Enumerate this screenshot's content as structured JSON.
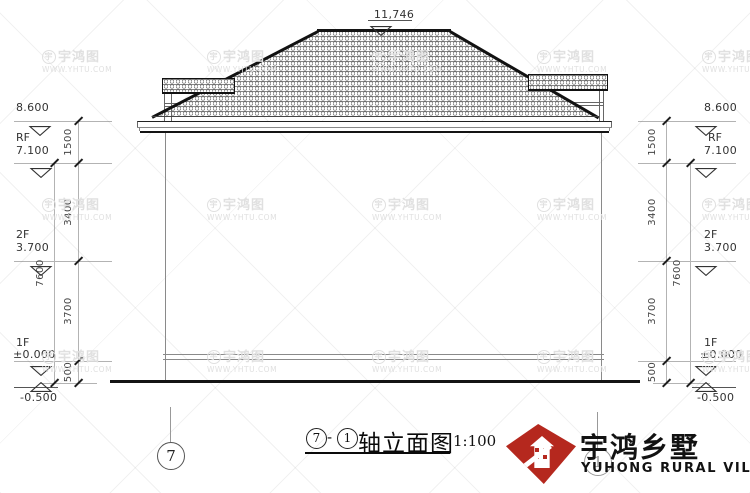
{
  "watermark": {
    "brand": "宇鸿图",
    "url": "WWW.YHTU.COM"
  },
  "top_dim": {
    "value": "11,746"
  },
  "left": {
    "levels": [
      {
        "name": "",
        "value": "8.600"
      },
      {
        "name": "RF",
        "value": "7.100"
      },
      {
        "name": "2F",
        "value": "3.700"
      },
      {
        "name": "1F",
        "value": "±0.000"
      },
      {
        "name": "",
        "value": "-0.500"
      }
    ],
    "dims": {
      "seg1": "1500",
      "seg2": "3400",
      "seg3": "3700",
      "seg4": "500",
      "total": "7600"
    }
  },
  "right": {
    "levels": [
      {
        "name": "",
        "value": "8.600"
      },
      {
        "name": "RF",
        "value": "7.100"
      },
      {
        "name": "2F",
        "value": "3.700"
      },
      {
        "name": "1F",
        "value": "±0.000"
      },
      {
        "name": "",
        "value": "-0.500"
      }
    ],
    "dims": {
      "seg1": "1500",
      "seg2": "3400",
      "seg3": "3700",
      "seg4": "500",
      "total": "7600"
    }
  },
  "axis": {
    "left": "7",
    "right": "1"
  },
  "title": {
    "axis_a": "7",
    "dash": "-",
    "axis_b": "1",
    "name": "轴立面图",
    "scale": "1:100"
  },
  "logo": {
    "cn": "宇鸿乡墅",
    "en": "YUHONG RURAL VILLAS"
  }
}
